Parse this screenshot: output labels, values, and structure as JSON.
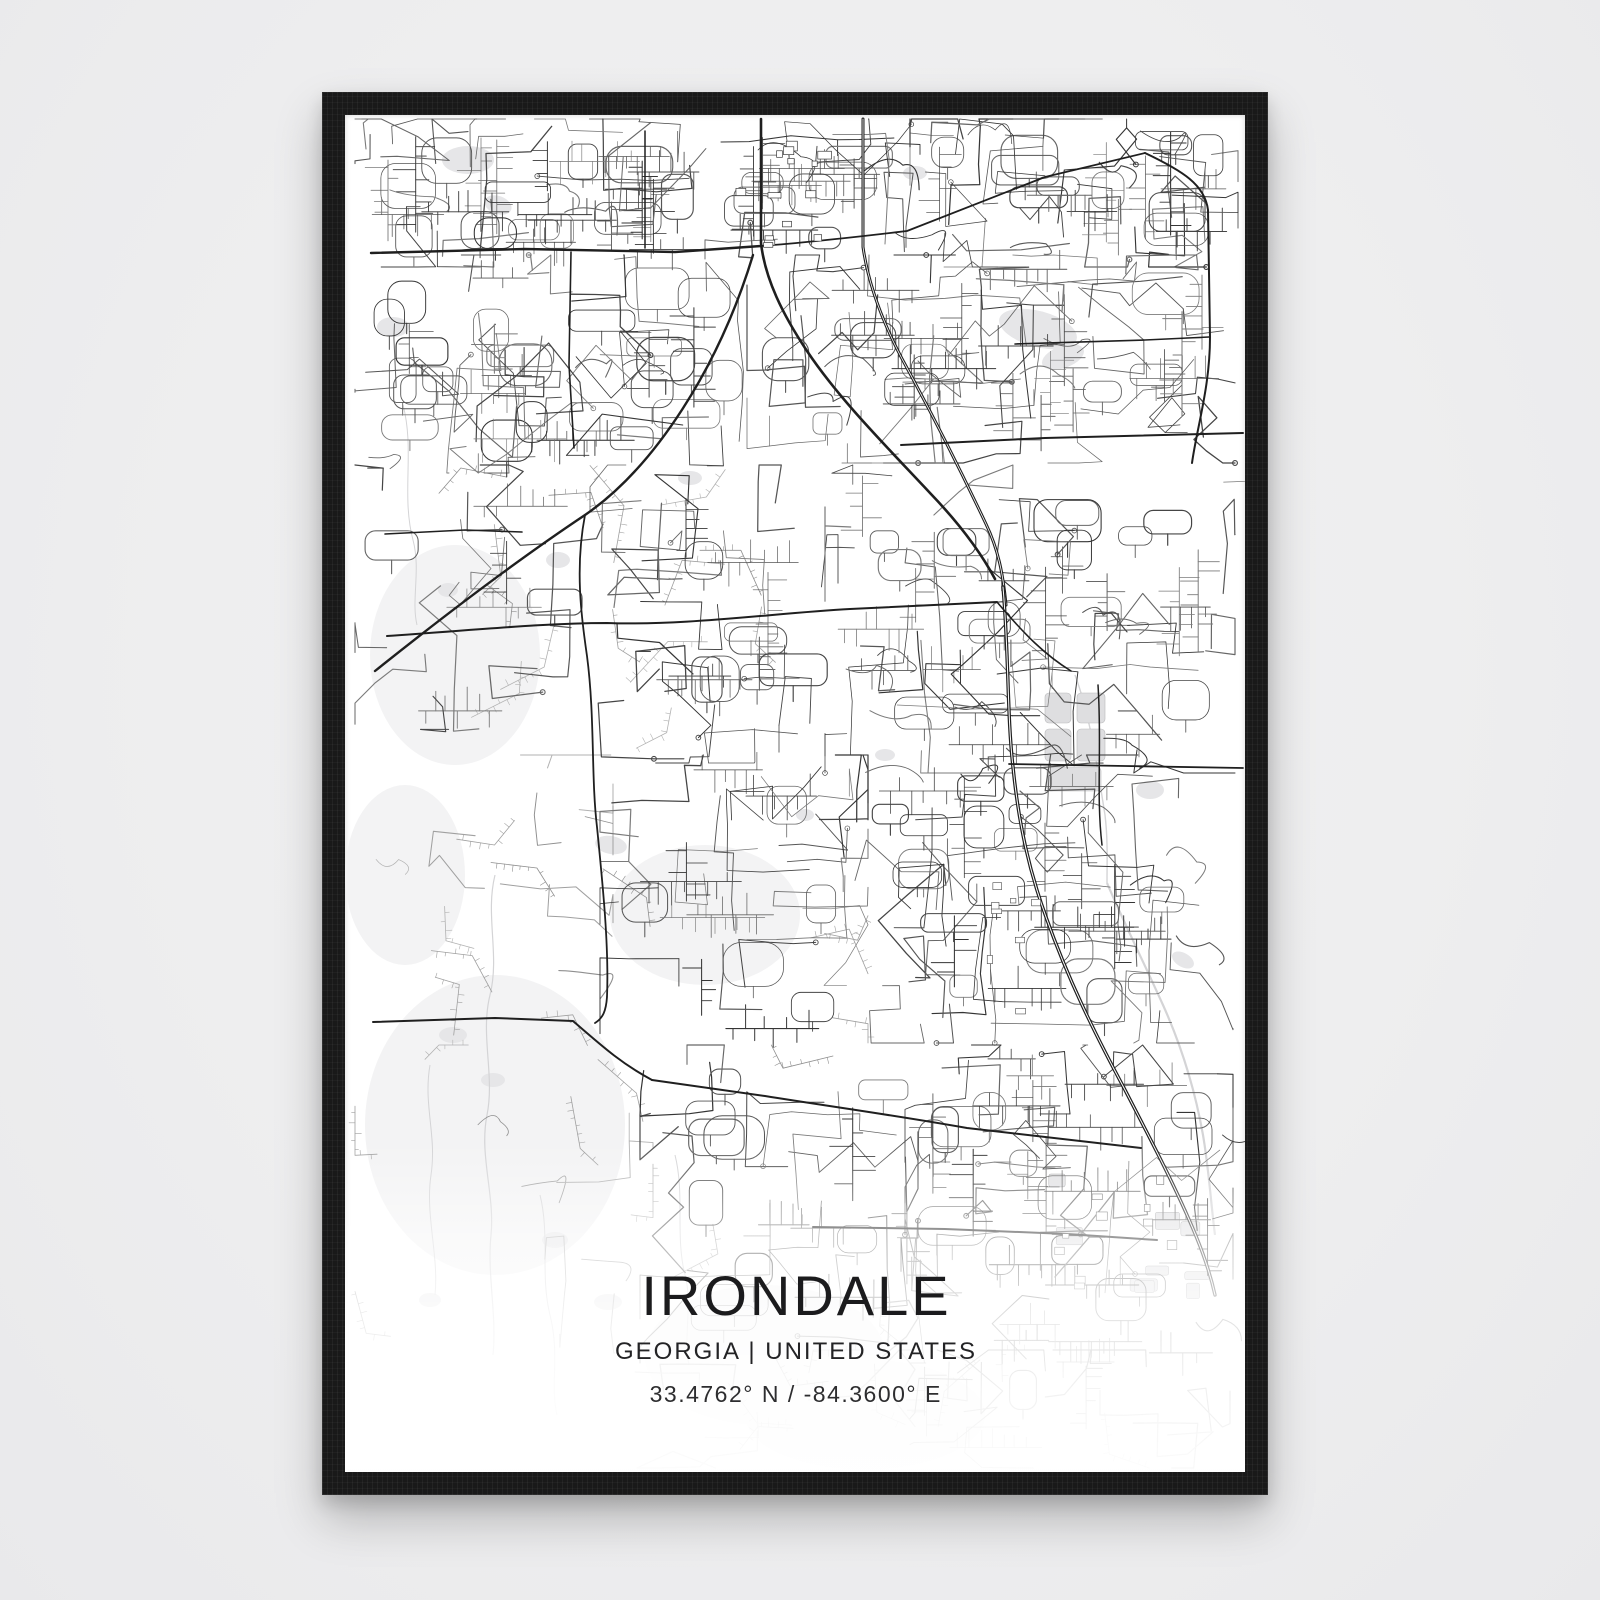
{
  "page": {
    "background": "#eeeeef"
  },
  "frame": {
    "color": "#191919"
  },
  "poster": {
    "title": "IRONDALE",
    "subtitle": "GEORGIA | UNITED STATES",
    "coordinates": "33.4762° N / -84.3600° E",
    "background": "#ffffff",
    "text_color": "#1b1b1d"
  },
  "map": {
    "road_color_major": "#1f1f1f",
    "road_color_minor": "#565656",
    "water_color": "#e6e6e8",
    "terrain_color": "#f3f3f4",
    "major_roads": [
      {
        "d": "M 416,4 L 416,128 C 420,164 438,200 462,236 C 494,284 542,332 585,378 C 610,404 634,434 650,464",
        "w": 2.6
      },
      {
        "d": "M 518,4 L 518,132 C 524,174 541,215 562,253 C 587,299 614,352 641,409 C 653,434 658,458 661,490",
        "w": 3,
        "center": true
      },
      {
        "d": "M 658,472 C 664,540 662,600 668,652 C 674,712 685,758 701,802 C 723,864 749,917 779,973 C 807,1027 833,1077 851,1121 C 860,1143 866,1162 870,1180",
        "w": 3.4,
        "center": true
      },
      {
        "d": "M 26,138 L 180,134 L 330,137 L 416,131",
        "w": 2.4
      },
      {
        "d": "M 416,131 C 470,127 520,121 562,116 L 700,62 L 800,38",
        "w": 1.8
      },
      {
        "d": "M 800,38 C 838,56 860,70 863,95 L 865,222 C 865,272 852,312 847,348",
        "w": 2
      },
      {
        "d": "M 30,556 C 110,492 180,440 240,400 C 310,352 374,252 408,140",
        "w": 2.4
      },
      {
        "d": "M 42,521 C 130,515 200,508 262,508 C 340,511 430,498 505,494 C 560,491 612,489 652,487",
        "w": 2
      },
      {
        "d": "M 556,330 L 700,323 L 898,318",
        "w": 2
      },
      {
        "d": "M 664,649 L 780,651 L 898,653",
        "w": 1.8
      },
      {
        "d": "M 240,400 C 230,452 236,500 242,541 C 250,602 246,662 252,712 C 258,772 264,832 262,882 C 261,896 258,903 250,908",
        "w": 1.8
      },
      {
        "d": "M 28,907 L 150,903 L 228,906 C 258,932 277,949 307,965",
        "w": 2
      },
      {
        "d": "M 307,965 L 420,981 C 482,991 542,999 622,1013 L 796,1033",
        "w": 2
      },
      {
        "d": "M 468,1112 L 600,1114 L 722,1119 L 812,1125",
        "w": 2
      },
      {
        "d": "M 226,137 L 224,250 L 229,333",
        "w": 1.6
      },
      {
        "d": "M 40,419 L 120,415 L 177,417",
        "w": 1.6
      },
      {
        "d": "M 670,229 L 800,225 L 864,222",
        "w": 1.6
      },
      {
        "d": "M 300,16 L 300,133",
        "w": 1.5
      },
      {
        "d": "M 753,570 C 757,630 751,680 757,730",
        "w": 1.5
      },
      {
        "d": "M 652,487 C 680,520 700,540 726,556",
        "w": 1.6
      }
    ]
  }
}
